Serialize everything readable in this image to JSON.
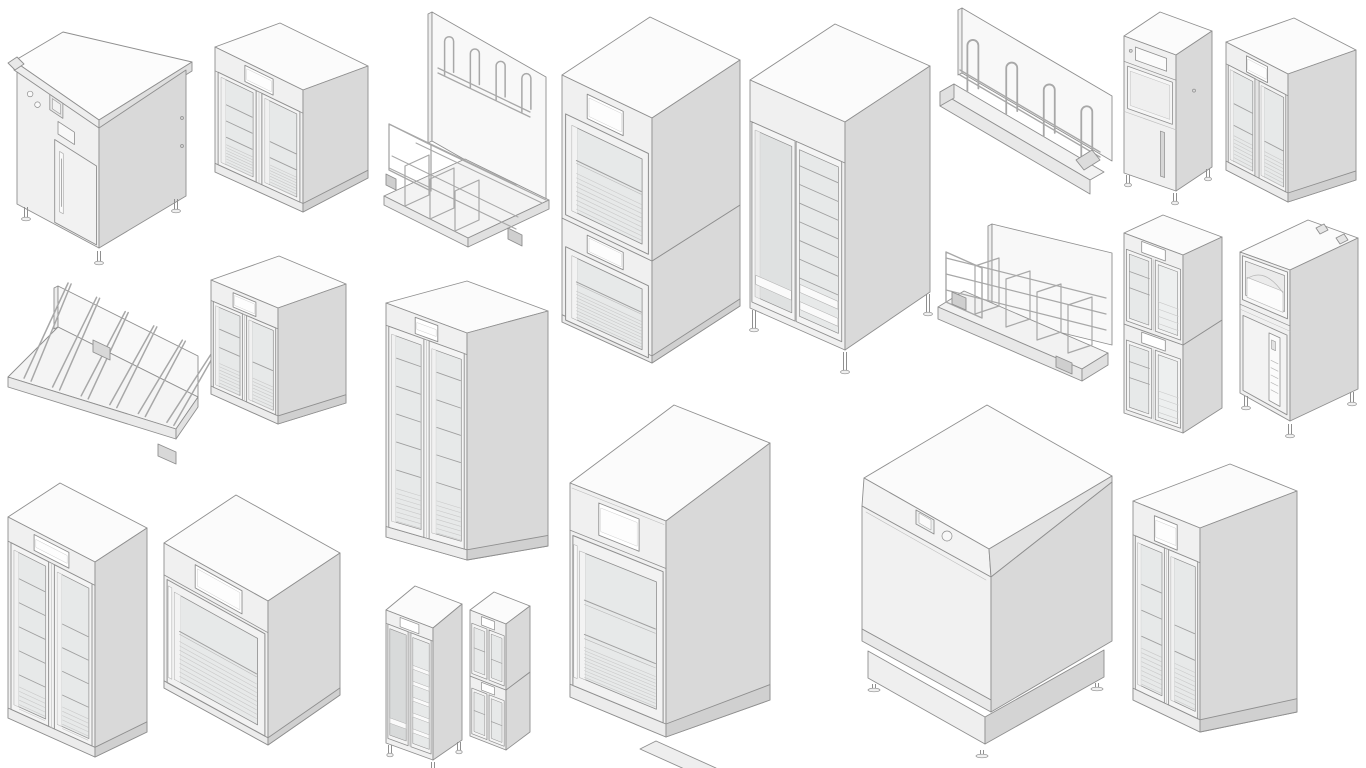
{
  "page": {
    "title": "Commercial kitchen appliance 3D model renders",
    "background": "#ffffff"
  },
  "palette": {
    "line": "#8f8f8f",
    "wire": "#a8a8a8",
    "top": "#fbfbfb",
    "front": "#f0f0f0",
    "side": "#d9d9d9",
    "frame": "#f4f4f4",
    "glass": "#e7e9e9",
    "glassDark": "#dfe1e1",
    "shelf": "#a0a0a0",
    "hatch": "#c9c9c9",
    "panel": "#f8f8f8",
    "white": "#ffffff",
    "plinth": "#ececec",
    "plinthSide": "#d0d0d0"
  },
  "items": [
    {
      "id": "washer1",
      "name": "pot washing machine",
      "kind": "machine"
    },
    {
      "id": "cooler2",
      "name": "double glass door cooler small",
      "kind": "cooler"
    },
    {
      "id": "rack3",
      "name": "wall rack with hooks and basket",
      "kind": "rack"
    },
    {
      "id": "stack4",
      "name": "stacked warming cabinets",
      "kind": "cabinet"
    },
    {
      "id": "banquet5",
      "name": "double door holding cabinet tall",
      "kind": "cabinet"
    },
    {
      "id": "rack6",
      "name": "wall rack with four hooks",
      "kind": "rack"
    },
    {
      "id": "machine7",
      "name": "narrow utility machine",
      "kind": "machine"
    },
    {
      "id": "cooler8",
      "name": "double glass door cooler compact",
      "kind": "cooler"
    },
    {
      "id": "rack9",
      "name": "wall board drying rack",
      "kind": "rack"
    },
    {
      "id": "cooler10",
      "name": "double glass door cooler medium",
      "kind": "cooler"
    },
    {
      "id": "cooler11",
      "name": "double glass door cooler tall",
      "kind": "cooler"
    },
    {
      "id": "rack12",
      "name": "wall wire divider rack",
      "kind": "rack"
    },
    {
      "id": "stack13",
      "name": "stacked four door coolers",
      "kind": "cooler"
    },
    {
      "id": "machine14",
      "name": "top loading utility machine",
      "kind": "machine"
    },
    {
      "id": "cooler15",
      "name": "double glass door cooler tall",
      "kind": "cooler"
    },
    {
      "id": "warm16",
      "name": "single door warming cabinet",
      "kind": "cabinet"
    },
    {
      "id": "cab17",
      "name": "narrow tray cabinet",
      "kind": "cabinet"
    },
    {
      "id": "stack18",
      "name": "stacked mini four door coolers",
      "kind": "cooler"
    },
    {
      "id": "warm19",
      "name": "large single door warming cabinet",
      "kind": "cabinet"
    },
    {
      "id": "dish20",
      "name": "undercounter dishwasher",
      "kind": "machine"
    },
    {
      "id": "cooler21",
      "name": "double glass door cooler large",
      "kind": "cooler"
    }
  ]
}
